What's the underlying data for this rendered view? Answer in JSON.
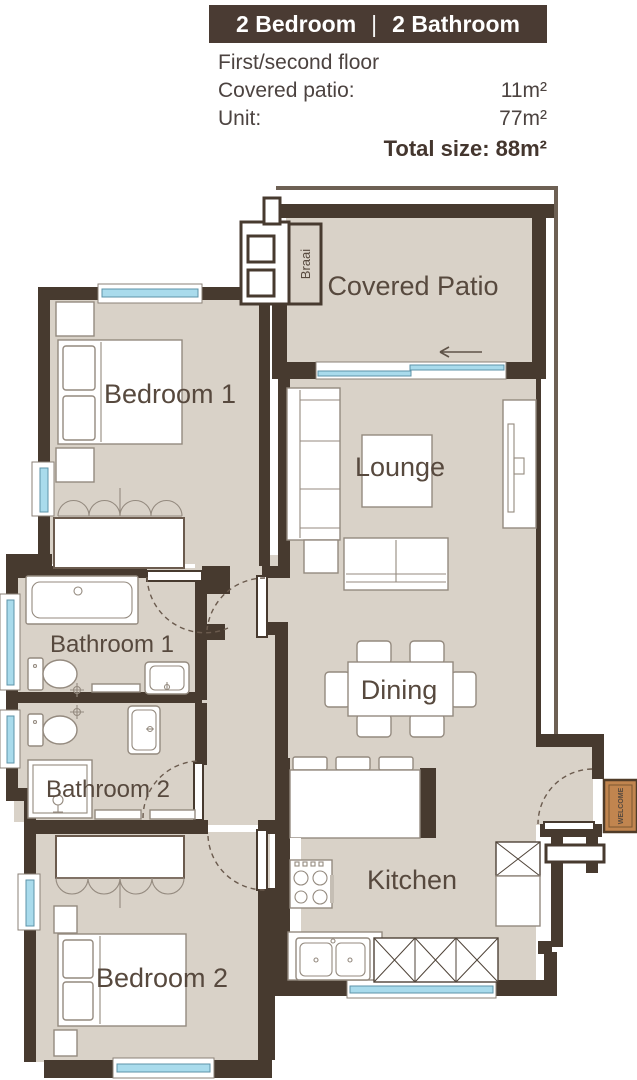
{
  "header": {
    "banner": {
      "left": "2 Bedroom",
      "separator": "|",
      "right": "2 Bathroom"
    },
    "floor_line": "First/second floor",
    "rows": [
      {
        "label": "Covered patio:",
        "value": "11m²"
      },
      {
        "label": "Unit:",
        "value": "77m²"
      }
    ],
    "total": "Total size: 88m²"
  },
  "rooms": {
    "covered_patio": "Covered Patio",
    "braai": "Braai",
    "bedroom1": "Bedroom 1",
    "lounge": "Lounge",
    "bathroom1": "Bathroom 1",
    "bathroom2": "Bathroom 2",
    "dining": "Dining",
    "kitchen": "Kitchen",
    "bedroom2": "Bedroom 2",
    "welcome_mat": "WELCOME"
  },
  "colors": {
    "banner_bg": "#4a3b33",
    "wall": "#473a2f",
    "floor": "#d9d2c8",
    "window_blue": "#a9dbec",
    "mat_orange": "#c1854f",
    "text": "#4c4340"
  }
}
